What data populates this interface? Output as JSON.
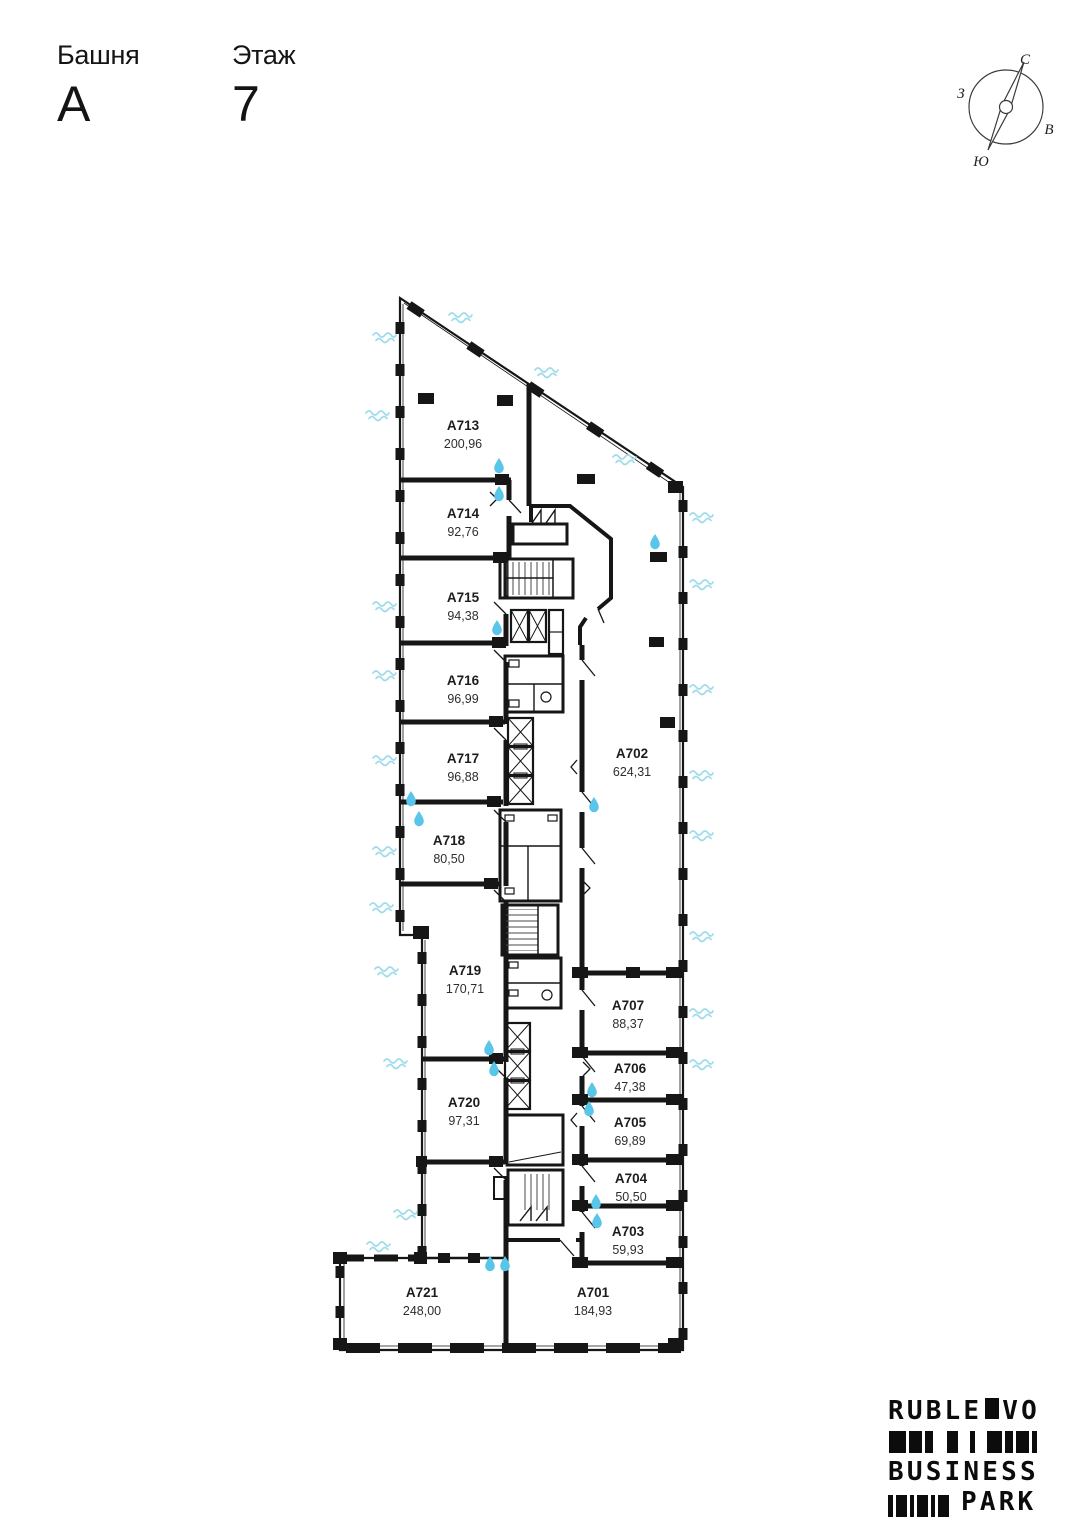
{
  "header": {
    "tower_label": "Башня",
    "tower_value": "А",
    "floor_label": "Этаж",
    "floor_value": "7"
  },
  "compass": {
    "north": "С",
    "east": "В",
    "south": "Ю",
    "west": "З"
  },
  "rooms": [
    {
      "id": "A713",
      "area": "200,96"
    },
    {
      "id": "A714",
      "area": "92,76"
    },
    {
      "id": "A715",
      "area": "94,38"
    },
    {
      "id": "A716",
      "area": "96,99"
    },
    {
      "id": "A717",
      "area": "96,88"
    },
    {
      "id": "A718",
      "area": "80,50"
    },
    {
      "id": "A719",
      "area": "170,71"
    },
    {
      "id": "A720",
      "area": "97,31"
    },
    {
      "id": "A721",
      "area": "248,00"
    },
    {
      "id": "A702",
      "area": "624,31"
    },
    {
      "id": "A707",
      "area": "88,37"
    },
    {
      "id": "A706",
      "area": "47,38"
    },
    {
      "id": "A705",
      "area": "69,89"
    },
    {
      "id": "A704",
      "area": "50,50"
    },
    {
      "id": "A703",
      "area": "59,93"
    },
    {
      "id": "A701",
      "area": "184,93"
    }
  ],
  "logo": {
    "line1_left": "RUBLE",
    "line1_right": "VO",
    "line2": "BUSINESS",
    "line3": "PARK"
  },
  "colors": {
    "wall": "#161616",
    "drop": "#58c5e9",
    "wave": "#9edbeb"
  }
}
